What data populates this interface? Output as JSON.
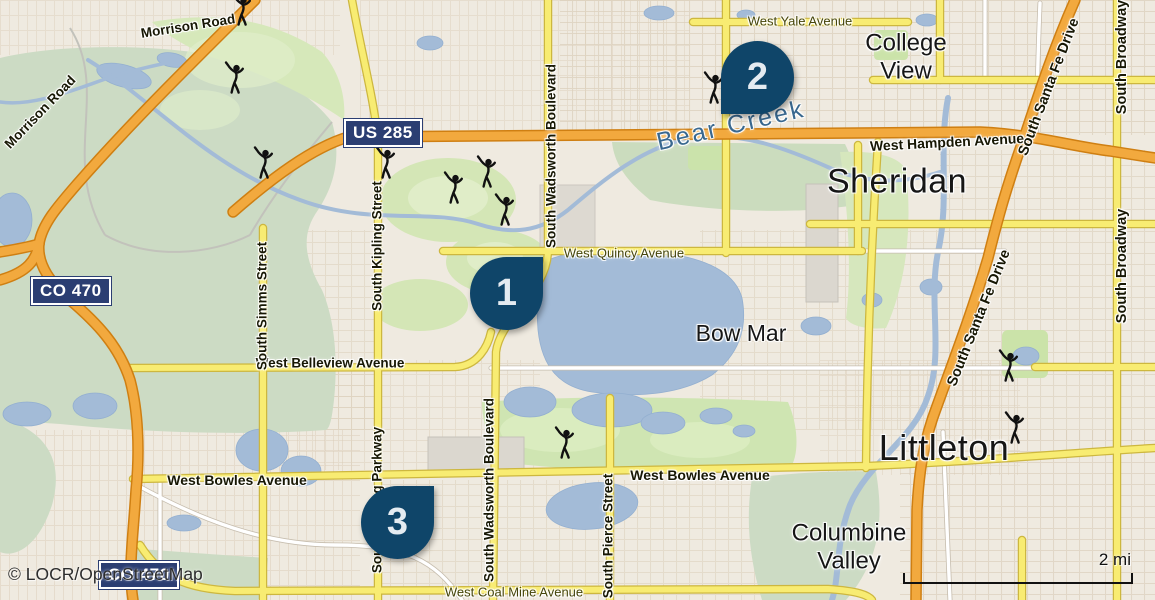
{
  "attribution": "© LOCR/OpenStreetMap",
  "scale": {
    "label": "2 mi"
  },
  "markers": [
    {
      "label": "1"
    },
    {
      "label": "2"
    },
    {
      "label": "3"
    }
  ],
  "shields": {
    "us285": "US 285",
    "co470_west": "CO 470",
    "co470_south": "CO 470"
  },
  "places": {
    "sheridan": "Sheridan",
    "littleton": "Littleton",
    "college_view": "College View",
    "bow_mar": "Bow Mar",
    "columbine_valley": "Columbine Valley"
  },
  "waterways": {
    "bear_creek": "Bear Creek"
  },
  "streets": {
    "morrison_1": "Morrison Road",
    "morrison_2": "Morrison Road",
    "yale": "West Yale Avenue",
    "hampden": "West Hampden Avenue",
    "quincy": "West Quincy Avenue",
    "belleview": "West Belleview Avenue",
    "bowles_1": "West Bowles Avenue",
    "bowles_2": "West Bowles Avenue",
    "coal_mine": "West Coal Mine Avenue",
    "wadsworth_1": "South Wadsworth Boulevard",
    "wadsworth_2": "South Wadsworth Boulevard",
    "kipling_street": "South Kipling Street",
    "kipling_parkway": "South Kipling Parkway",
    "simms": "South Simms Street",
    "pierce": "South Pierce Street",
    "broadway_1": "South Broadway",
    "broadway_2": "South Broadway",
    "santa_fe_1": "South Santa Fe Drive",
    "santa_fe_2": "South Santa Fe Drive"
  },
  "colors": {
    "marker": "#0f4569",
    "shield": "#2b3e72",
    "highway_orange": "#f2a93e",
    "secondary_yellow": "#f8ec72",
    "water": "#a3bbd7",
    "park_green": "#d4e6b6",
    "nature_green": "#ccdbc4",
    "background": "#efeae0"
  }
}
